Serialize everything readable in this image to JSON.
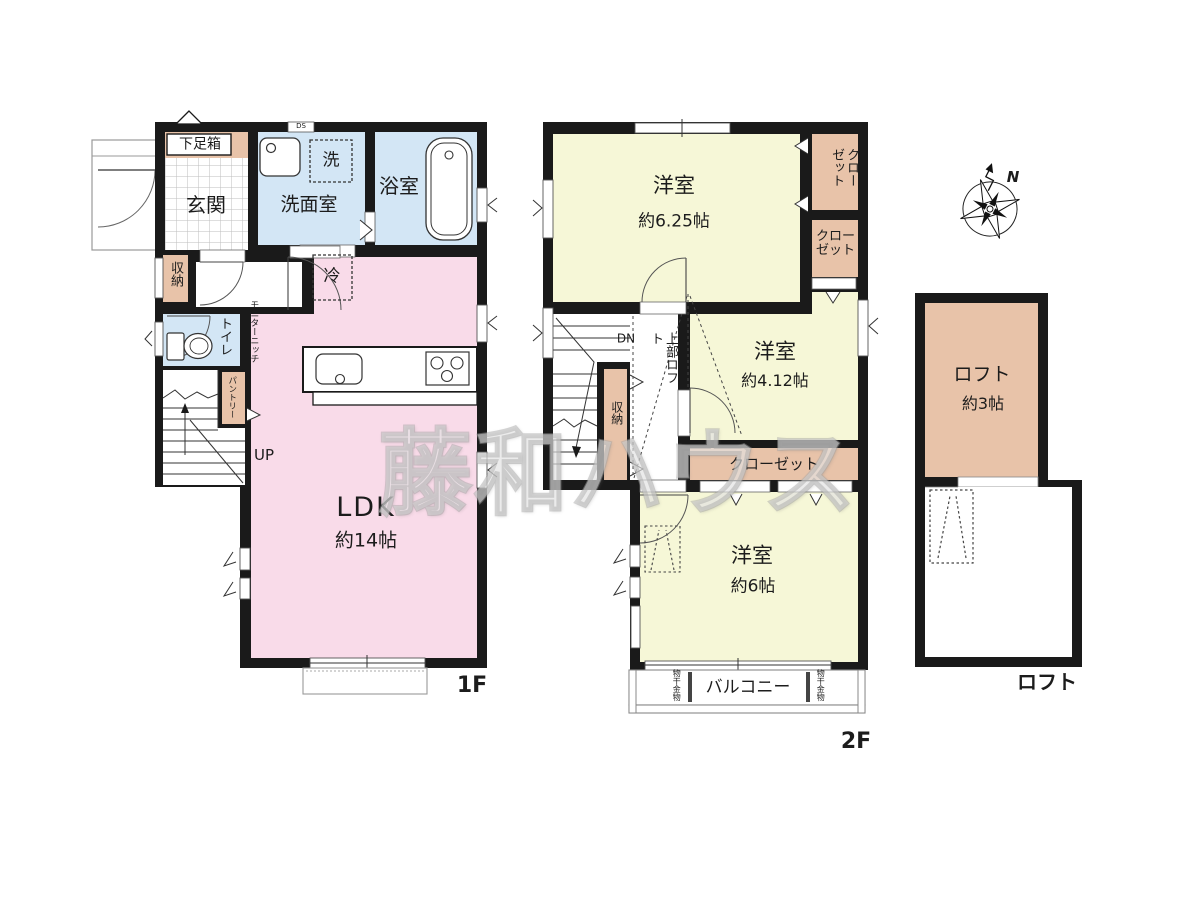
{
  "watermark": "藤和ハウス",
  "compass": {
    "north": "N"
  },
  "colors": {
    "wall": "#1a1a1a",
    "tan": "#e8c3a9",
    "blue": "#d3e6f5",
    "pink": "#f9dbe9",
    "yellow": "#f6f7d7",
    "outline": "#999999"
  },
  "f1": {
    "floor_label": "1F",
    "shoe_box": "下足箱",
    "entrance": "玄関",
    "washroom": "洗面室",
    "laundry": "洗",
    "ds": "DS",
    "bath": "浴室",
    "storage": "収納",
    "toilet": "トイレ",
    "pantry": "パントリー",
    "monitor_niche": "モニターニッチ",
    "fridge": "冷",
    "ldk": "LDK",
    "ldk_size": "約14帖",
    "up": "UP"
  },
  "f2": {
    "floor_label": "2F",
    "dn": "DN",
    "room_a": "洋室",
    "room_a_size": "約6.25帖",
    "room_b": "洋室",
    "room_b_size": "約4.12帖",
    "room_c": "洋室",
    "room_c_size": "約6帖",
    "closet_top": "クローゼット",
    "closet_mid": "クローゼット",
    "closet_low": "クローゼット",
    "storage": "収納",
    "upper_loft": "上部ロフト",
    "balcony": "バルコニー",
    "drying_left": "物干金物",
    "drying_right": "物干金物"
  },
  "loft": {
    "floor_label": "ロフト",
    "room": "ロフト",
    "size": "約3帖"
  }
}
